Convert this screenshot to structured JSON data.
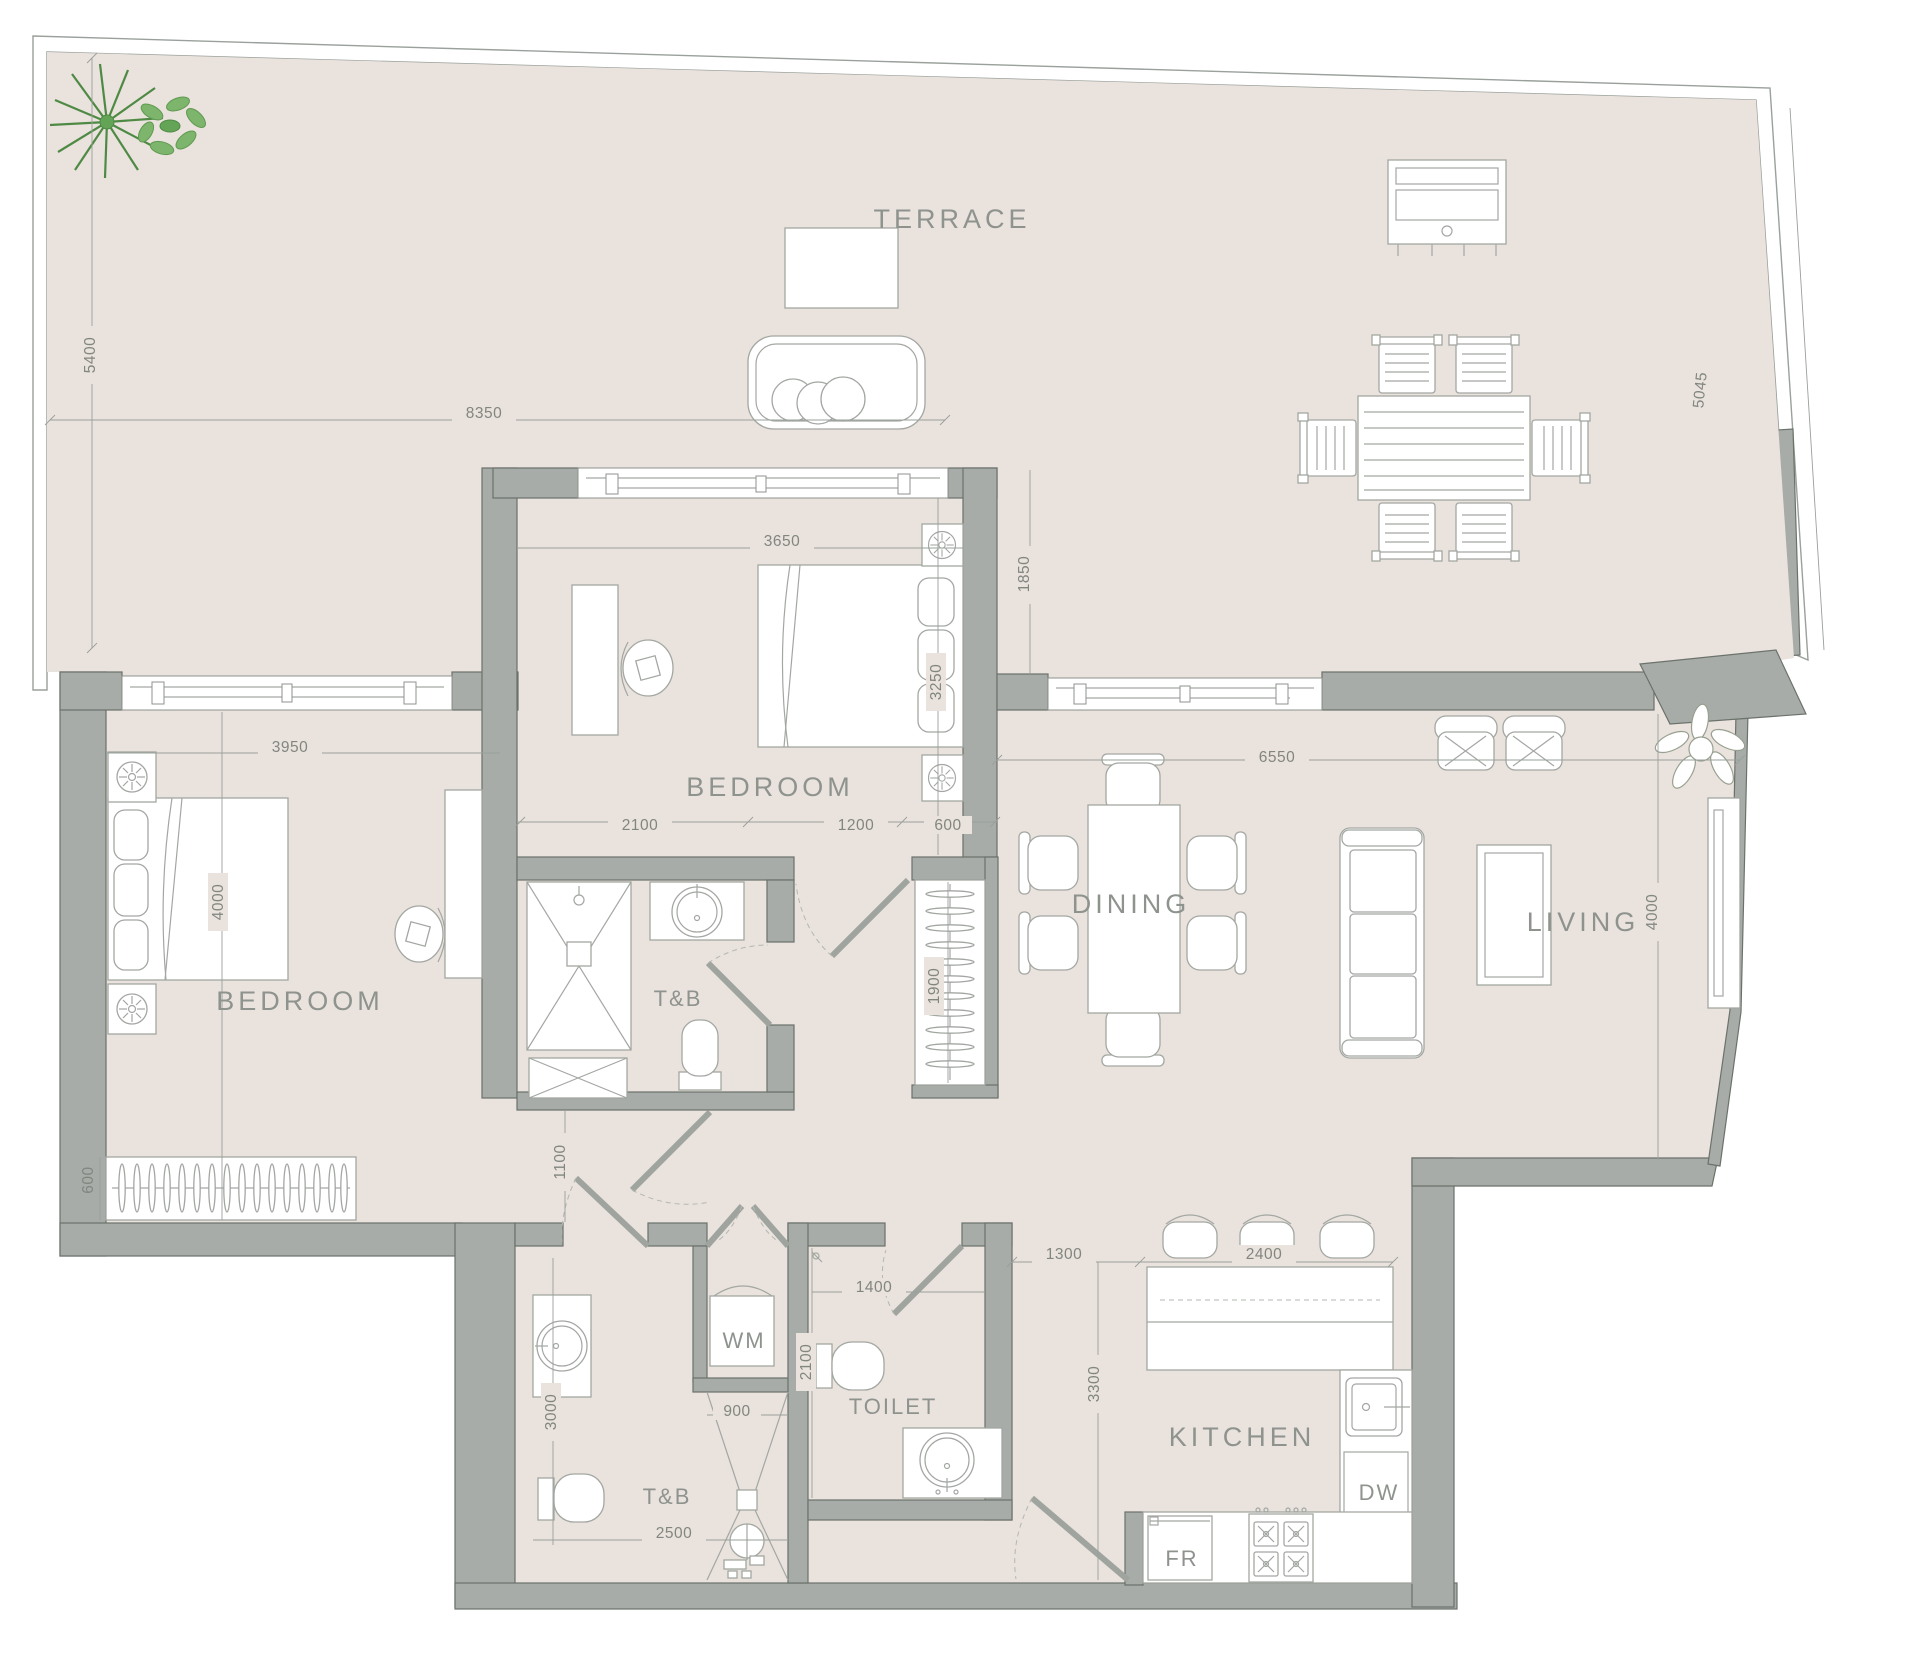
{
  "rooms": {
    "terrace": "TERRACE",
    "bedroom1": "BEDROOM",
    "bedroom2": "BEDROOM",
    "tb_upper": "T&B",
    "tb_lower": "T&B",
    "toilet": "TOILET",
    "wm": "WM",
    "dining": "DINING",
    "living": "LIVING",
    "kitchen": "KITCHEN",
    "dw": "DW",
    "fr": "FR"
  },
  "dims": {
    "terrace_depth_left": "5400",
    "terrace_width": "8350",
    "terrace_depth_right": "5045",
    "terrace_mid_depth": "1850",
    "bedroom1_width": "3950",
    "bedroom1_depth": "4000",
    "bedroom1_closet_depth": "600",
    "bedroom2_width": "3650",
    "bedroom2_depth": "3250",
    "bedroom2_seg1": "2100",
    "bedroom2_seg2": "1200",
    "bedroom2_seg3": "600",
    "hall_closet_depth": "1900",
    "corridor_width": "1100",
    "tb2_length": "3000",
    "tb2_width": "2500",
    "shower_width": "900",
    "toilet_length": "2100",
    "toilet_width": "1400",
    "kitchen_pass": "1300",
    "island_length": "2400",
    "kitchen_depth": "3300",
    "living_width": "6550",
    "living_depth": "4000"
  },
  "colors": {
    "floor": "#eae2dd",
    "wall": "#a7aca8",
    "plant_green": "#63a457",
    "line": "#9aa09b",
    "label_text": "#8e938e"
  }
}
